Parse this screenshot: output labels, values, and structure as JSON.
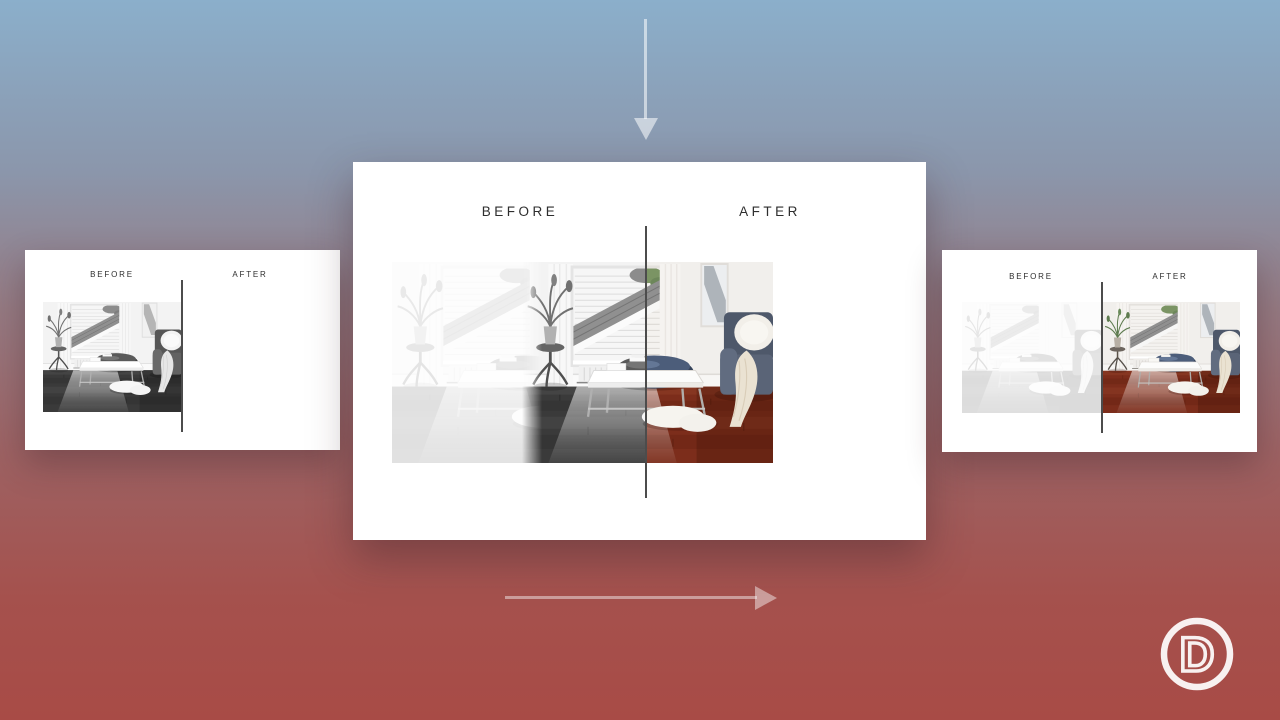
{
  "cards": {
    "left": {
      "before_label": "BEFORE",
      "after_label": "AFTER"
    },
    "center": {
      "before_label": "BEFORE",
      "after_label": "AFTER"
    },
    "right": {
      "before_label": "BEFORE",
      "after_label": "AFTER"
    }
  },
  "logo": {
    "letter": "D"
  },
  "icons": {
    "down_arrow": "down-arrow",
    "right_arrow": "right-arrow",
    "slider_divider": "vertical-slider-handle",
    "logo_mark": "divi-circle-d-logo"
  },
  "colors": {
    "bg_top": "#8bafcb",
    "bg_bottom": "#a84b46",
    "card_bg": "#ffffff",
    "divider": "#4c4c4c",
    "label_text": "#2e2e2e",
    "arrow_on_blue": "rgba(255,255,255,0.55)",
    "arrow_on_red": "rgba(255,255,255,0.45)",
    "logo_ring": "rgba(255,255,255,0.92)",
    "floor_color": "#7c2d1b",
    "sofa_color": "#4e586a"
  }
}
